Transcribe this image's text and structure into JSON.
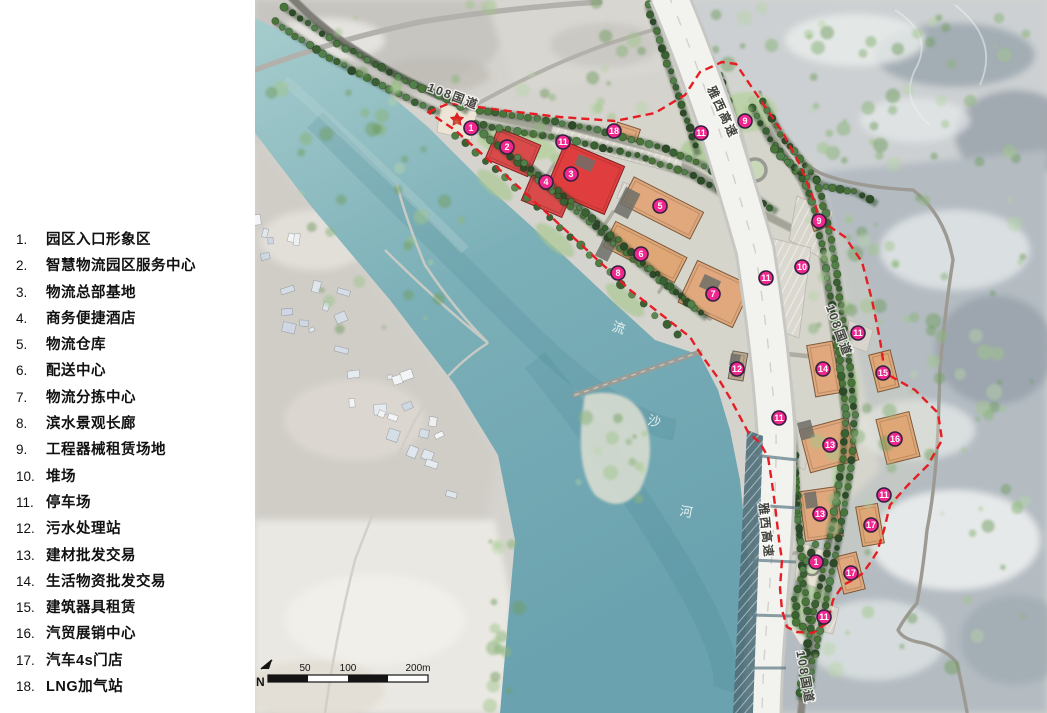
{
  "legend": {
    "items": [
      {
        "num": "1.",
        "label": "园区入口形象区"
      },
      {
        "num": "2.",
        "label": "智慧物流园区服务中心"
      },
      {
        "num": "3.",
        "label": "物流总部基地"
      },
      {
        "num": "4.",
        "label": "商务便捷酒店"
      },
      {
        "num": "5.",
        "label": "物流仓库"
      },
      {
        "num": "6.",
        "label": "配送中心"
      },
      {
        "num": "7.",
        "label": "物流分拣中心"
      },
      {
        "num": "8.",
        "label": "滨水景观长廊"
      },
      {
        "num": "9.",
        "label": "工程器械租赁场地"
      },
      {
        "num": "10.",
        "label": "堆场"
      },
      {
        "num": "11.",
        "label": "停车场"
      },
      {
        "num": "12.",
        "label": "污水处理站"
      },
      {
        "num": "13.",
        "label": "建材批发交易"
      },
      {
        "num": "14.",
        "label": "生活物资批发交易"
      },
      {
        "num": "15.",
        "label": "建筑器具租赁"
      },
      {
        "num": "16.",
        "label": "汽贸展销中心"
      },
      {
        "num": "17.",
        "label": "汽车4s门店"
      },
      {
        "num": "18.",
        "label": "LNG加气站"
      }
    ]
  },
  "map": {
    "markers": [
      {
        "n": "1",
        "x": 216,
        "y": 128
      },
      {
        "n": "2",
        "x": 252,
        "y": 147
      },
      {
        "n": "11",
        "x": 308,
        "y": 142
      },
      {
        "n": "18",
        "x": 359,
        "y": 131
      },
      {
        "n": "3",
        "x": 316,
        "y": 174
      },
      {
        "n": "4",
        "x": 291,
        "y": 182
      },
      {
        "n": "5",
        "x": 405,
        "y": 206
      },
      {
        "n": "6",
        "x": 386,
        "y": 254
      },
      {
        "n": "8",
        "x": 363,
        "y": 273
      },
      {
        "n": "7",
        "x": 458,
        "y": 294
      },
      {
        "n": "11",
        "x": 446,
        "y": 133
      },
      {
        "n": "9",
        "x": 490,
        "y": 121
      },
      {
        "n": "9",
        "x": 564,
        "y": 221
      },
      {
        "n": "10",
        "x": 547,
        "y": 267
      },
      {
        "n": "11",
        "x": 511,
        "y": 278
      },
      {
        "n": "11",
        "x": 603,
        "y": 333
      },
      {
        "n": "12",
        "x": 482,
        "y": 369
      },
      {
        "n": "14",
        "x": 568,
        "y": 369
      },
      {
        "n": "15",
        "x": 628,
        "y": 373
      },
      {
        "n": "11",
        "x": 524,
        "y": 418
      },
      {
        "n": "13",
        "x": 575,
        "y": 445
      },
      {
        "n": "16",
        "x": 640,
        "y": 439
      },
      {
        "n": "11",
        "x": 629,
        "y": 495
      },
      {
        "n": "13",
        "x": 565,
        "y": 514
      },
      {
        "n": "17",
        "x": 616,
        "y": 525
      },
      {
        "n": "1",
        "x": 561,
        "y": 562
      },
      {
        "n": "17",
        "x": 596,
        "y": 573
      },
      {
        "n": "11",
        "x": 569,
        "y": 617
      }
    ],
    "road_labels": [
      {
        "text": "108国道"
      },
      {
        "text": "雅西高速"
      },
      {
        "text": "108国道"
      },
      {
        "text": "雅西高速"
      },
      {
        "text": "108国道"
      }
    ],
    "river_label": {
      "text": "流沙河",
      "chars": [
        {
          "c": "流"
        },
        {
          "c": "沙"
        },
        {
          "c": "河"
        }
      ]
    },
    "scale_bar": {
      "n_label": "N",
      "ticks": [
        "50",
        "100",
        "200m"
      ]
    },
    "colors": {
      "boundary": "#e61e24",
      "marker": "#f0288e",
      "marker_ring": "#331f3f",
      "red_building": "#dd4040",
      "tan_building": "#e0a87c",
      "water": "#79aab4"
    }
  }
}
